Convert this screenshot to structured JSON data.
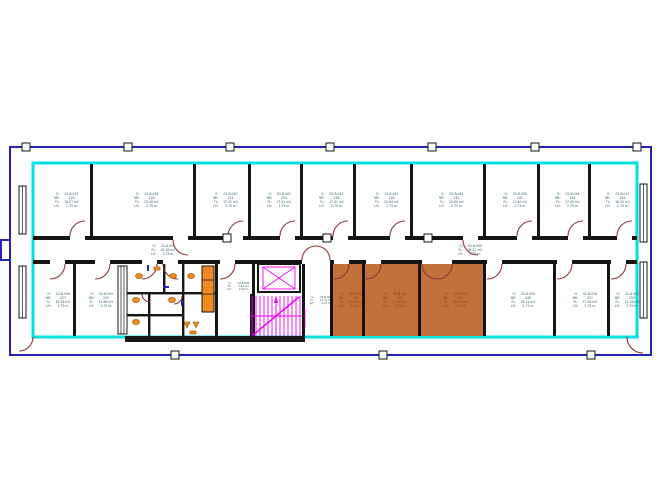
{
  "colors": {
    "navy": "#2323b4",
    "cyan": "#00e0e0",
    "wall": "#151515",
    "door": "#8a3535",
    "magenta": "#f000f0",
    "highlight_fill": "#c4703a",
    "highlight_text": "#8c3a12",
    "stamp_text": "#2f6068",
    "fixture": "#ef8a1f",
    "fixture_stroke": "#9a5505"
  },
  "stamp_tags": {
    "g": "G:",
    "nr": "NR:",
    "fl": "FL:",
    "lh": "LH:"
  },
  "stairs": {
    "note": "18x0.18/0.28"
  },
  "rooms": [
    {
      "id": "02.B.037",
      "nr": "226",
      "area": "14.27 m2",
      "height": "2.75 m",
      "x": 33,
      "y": 164,
      "w": 57,
      "h": 72
    },
    {
      "id": "02.B.038",
      "nr": "228",
      "area": "23.46 m2",
      "height": "2.75 m",
      "x": 90,
      "y": 164,
      "w": 103,
      "h": 72
    },
    {
      "id": "02.B.040",
      "nr": "232",
      "area": "17.52 m2",
      "height": "2.75 m",
      "x": 193,
      "y": 164,
      "w": 55,
      "h": 72
    },
    {
      "id": "02.B.041",
      "nr": "234",
      "area": "17.41 m2",
      "height": "2.75 m",
      "x": 248,
      "y": 164,
      "w": 52,
      "h": 72
    },
    {
      "id": "02.B.042",
      "nr": "236",
      "area": "17.41 m2",
      "height": "2.75 m",
      "x": 300,
      "y": 164,
      "w": 53,
      "h": 72
    },
    {
      "id": "02.B.043",
      "nr": "238",
      "area": "24.94 m2",
      "height": "2.75 m",
      "x": 353,
      "y": 164,
      "w": 57,
      "h": 72
    },
    {
      "id": "02.B.044",
      "nr": "240",
      "area": "20.64 m2",
      "height": "2.75 m",
      "x": 410,
      "y": 164,
      "w": 73,
      "h": 72
    },
    {
      "id": "02.B.045",
      "nr": "242",
      "area": "17.40 m2",
      "height": "2.75 m",
      "x": 483,
      "y": 164,
      "w": 54,
      "h": 72
    },
    {
      "id": "02.B.046",
      "nr": "244",
      "area": "17.40 m2",
      "height": "2.75 m",
      "x": 537,
      "y": 164,
      "w": 51,
      "h": 72
    },
    {
      "id": "02.B.047",
      "nr": "246",
      "area": "18.50 m2",
      "height": "2.70 m",
      "x": 588,
      "y": 164,
      "w": 49,
      "h": 72
    },
    {
      "id": "02.B.004",
      "area": "42.38 m2",
      "height": "2.75 m",
      "x": 33,
      "y": 238,
      "w": 250,
      "h": 24
    },
    {
      "id": "02.B.050",
      "area": "38.51 m2",
      "height": "2.75 m",
      "x": 330,
      "y": 238,
      "w": 270,
      "h": 24
    },
    {
      "id": "02.B.058",
      "nr": "227",
      "area": "16.36 m2",
      "height": "2.75 m",
      "x": 33,
      "y": 264,
      "w": 40,
      "h": 72
    },
    {
      "id": "02.B.059",
      "nr": "229",
      "area": "15.86 m2",
      "height": "2.75 m",
      "x": 73,
      "y": 264,
      "w": 46,
      "h": 72
    },
    {
      "id": "02.B.006",
      "area": "3.94 m2",
      "height": "2.64 m",
      "x": 215,
      "y": 264,
      "w": 37,
      "h": 44,
      "small": true
    },
    {
      "id": "02.B.009",
      "area": "11.74 m2",
      "height": "2.70 m",
      "x": 302,
      "y": 264,
      "w": 28,
      "h": 72,
      "small": true
    },
    {
      "id": "02.B.051",
      "nr": "243",
      "area": "11.09 m2",
      "height": "2.75 m",
      "x": 330,
      "y": 264,
      "w": 32,
      "h": 72,
      "highlight": true
    },
    {
      "id": "02.B.052",
      "nr": "245",
      "area": "17.80 m2",
      "height": "2.75 m",
      "x": 362,
      "y": 264,
      "w": 56,
      "h": 72,
      "highlight": true
    },
    {
      "id": "02.B.053",
      "nr": "247",
      "area": "23.52 m2",
      "height": "2.75 m",
      "x": 418,
      "y": 264,
      "w": 65,
      "h": 72,
      "highlight": true
    },
    {
      "id": "02.B.055",
      "nr": "249",
      "area": "26.12 m2",
      "height": "2.75 m",
      "x": 483,
      "y": 264,
      "w": 70,
      "h": 72
    },
    {
      "id": "02.B.056",
      "nr": "251",
      "area": "17.46 m2",
      "height": "2.75 m",
      "x": 553,
      "y": 264,
      "w": 54,
      "h": 72
    },
    {
      "id": "02.B.057",
      "nr": "253",
      "area": "12.26 m2",
      "height": "2.70 m",
      "x": 607,
      "y": 264,
      "w": 30,
      "h": 72
    }
  ]
}
